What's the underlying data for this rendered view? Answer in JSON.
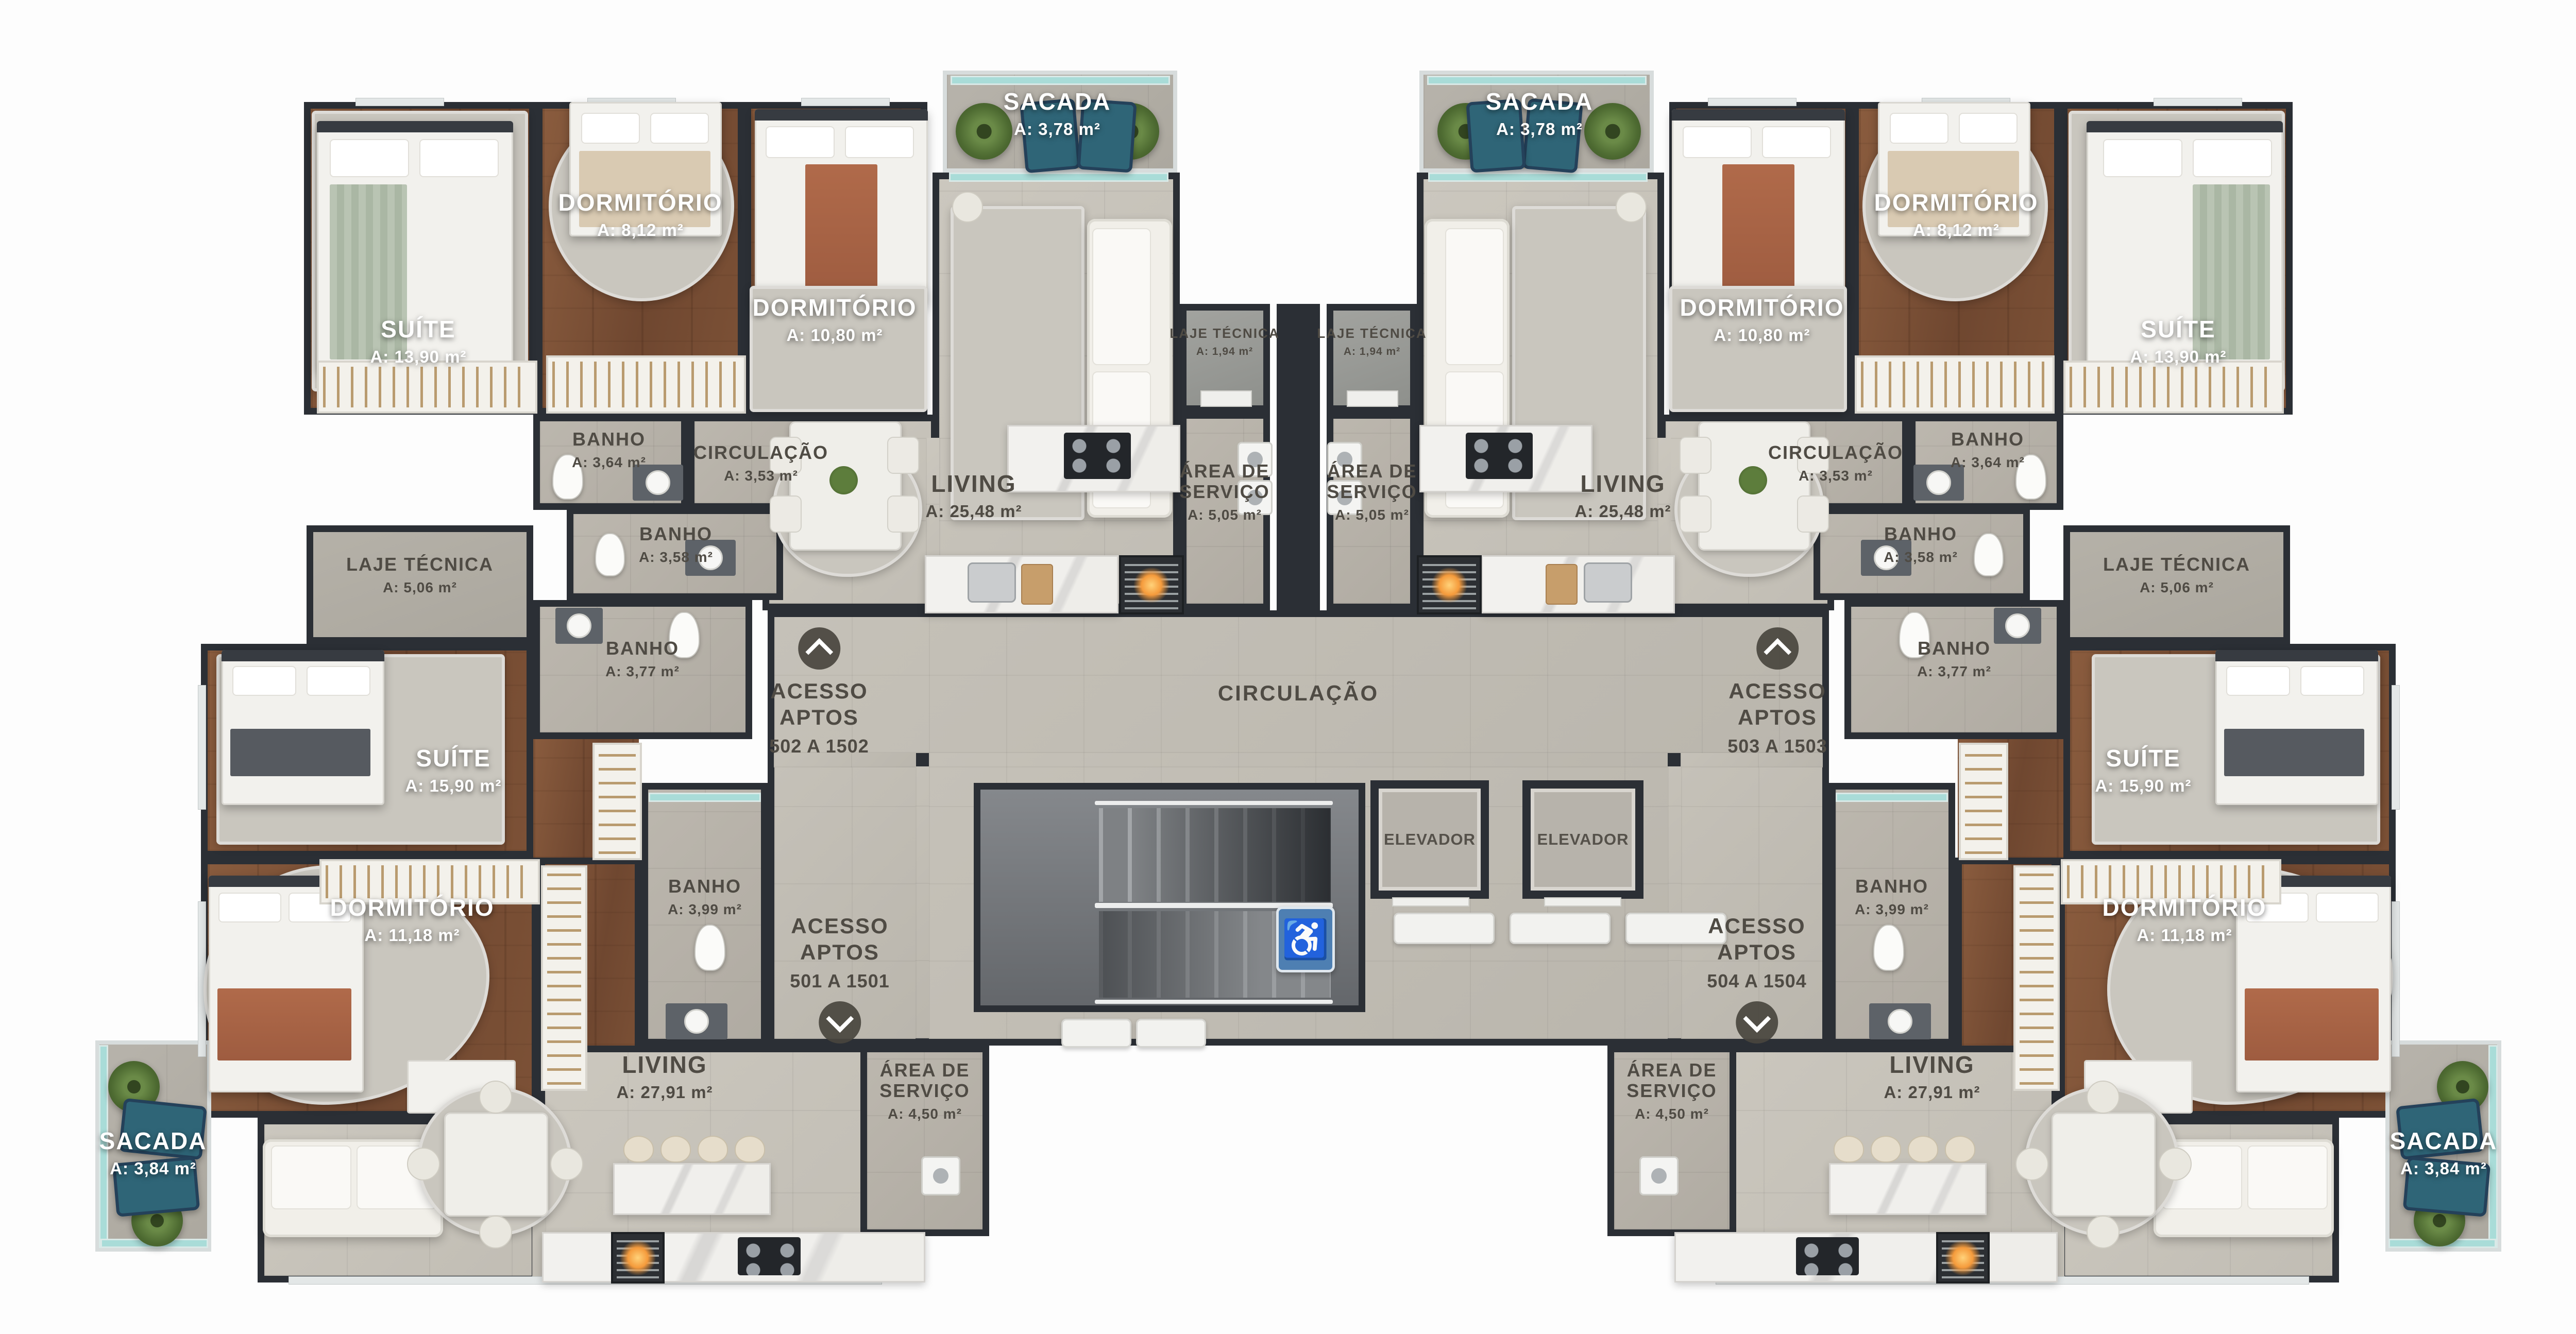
{
  "plan": {
    "wall_color": "#2b2f35",
    "glass_teal": "#a9dcd8",
    "accessible_blue": "#4e7fb2",
    "fire_orange": "#f59b3c",
    "label_dark": "#4f4b44",
    "label_light": "#ffffff"
  },
  "labels": {
    "suite_1390": {
      "name": "SUÍTE",
      "area": "A: 13,90 m²"
    },
    "dorm_812": {
      "name": "DORMITÓRIO",
      "area": "A: 8,12 m²"
    },
    "dorm_1080": {
      "name": "DORMITÓRIO",
      "area": "A: 10,80 m²"
    },
    "sacada_378": {
      "name": "SACADA",
      "area": "A: 3,78 m²"
    },
    "laje_194": {
      "name": "LAJE TÉCNICA",
      "area": "A: 1,94 m²"
    },
    "banho_364": {
      "name": "BANHO",
      "area": "A: 3,64 m²"
    },
    "circ_353": {
      "name": "CIRCULAÇÃO",
      "area": "A: 3,53 m²"
    },
    "banho_358": {
      "name": "BANHO",
      "area": "A: 3,58 m²"
    },
    "living_2548": {
      "name": "LIVING",
      "area": "A: 25,48 m²"
    },
    "servico_505": {
      "name": "ÁREA DE SERVIÇO",
      "area": "A: 5,05 m²"
    },
    "laje_506": {
      "name": "LAJE TÉCNICA",
      "area": "A: 5,06 m²"
    },
    "banho_377": {
      "name": "BANHO",
      "area": "A: 3,77 m²"
    },
    "suite_1590": {
      "name": "SUÍTE",
      "area": "A: 15,90 m²"
    },
    "banho_399": {
      "name": "BANHO",
      "area": "A: 3,99 m²"
    },
    "dorm_1118": {
      "name": "DORMITÓRIO",
      "area": "A: 11,18 m²"
    },
    "living_2791": {
      "name": "LIVING",
      "area": "A: 27,91 m²"
    },
    "servico_450": {
      "name": "ÁREA DE SERVIÇO",
      "area": "A: 4,50 m²"
    },
    "sacada_384": {
      "name": "SACADA",
      "area": "A: 3,84 m²"
    },
    "circulacao": {
      "name": "CIRCULAÇÃO"
    },
    "elevador": {
      "name": "ELEVADOR"
    }
  },
  "acessos": {
    "a502": {
      "l1": "ACESSO",
      "l2": "APTOS",
      "range": "502 A 1502",
      "dir": "up"
    },
    "a503": {
      "l1": "ACESSO",
      "l2": "APTOS",
      "range": "503 A 1503",
      "dir": "up"
    },
    "a501": {
      "l1": "ACESSO",
      "l2": "APTOS",
      "range": "501 A 1501",
      "dir": "down"
    },
    "a504": {
      "l1": "ACESSO",
      "l2": "APTOS",
      "range": "504 A 1504",
      "dir": "down"
    }
  },
  "icons": {
    "wheelchair": "♿"
  }
}
